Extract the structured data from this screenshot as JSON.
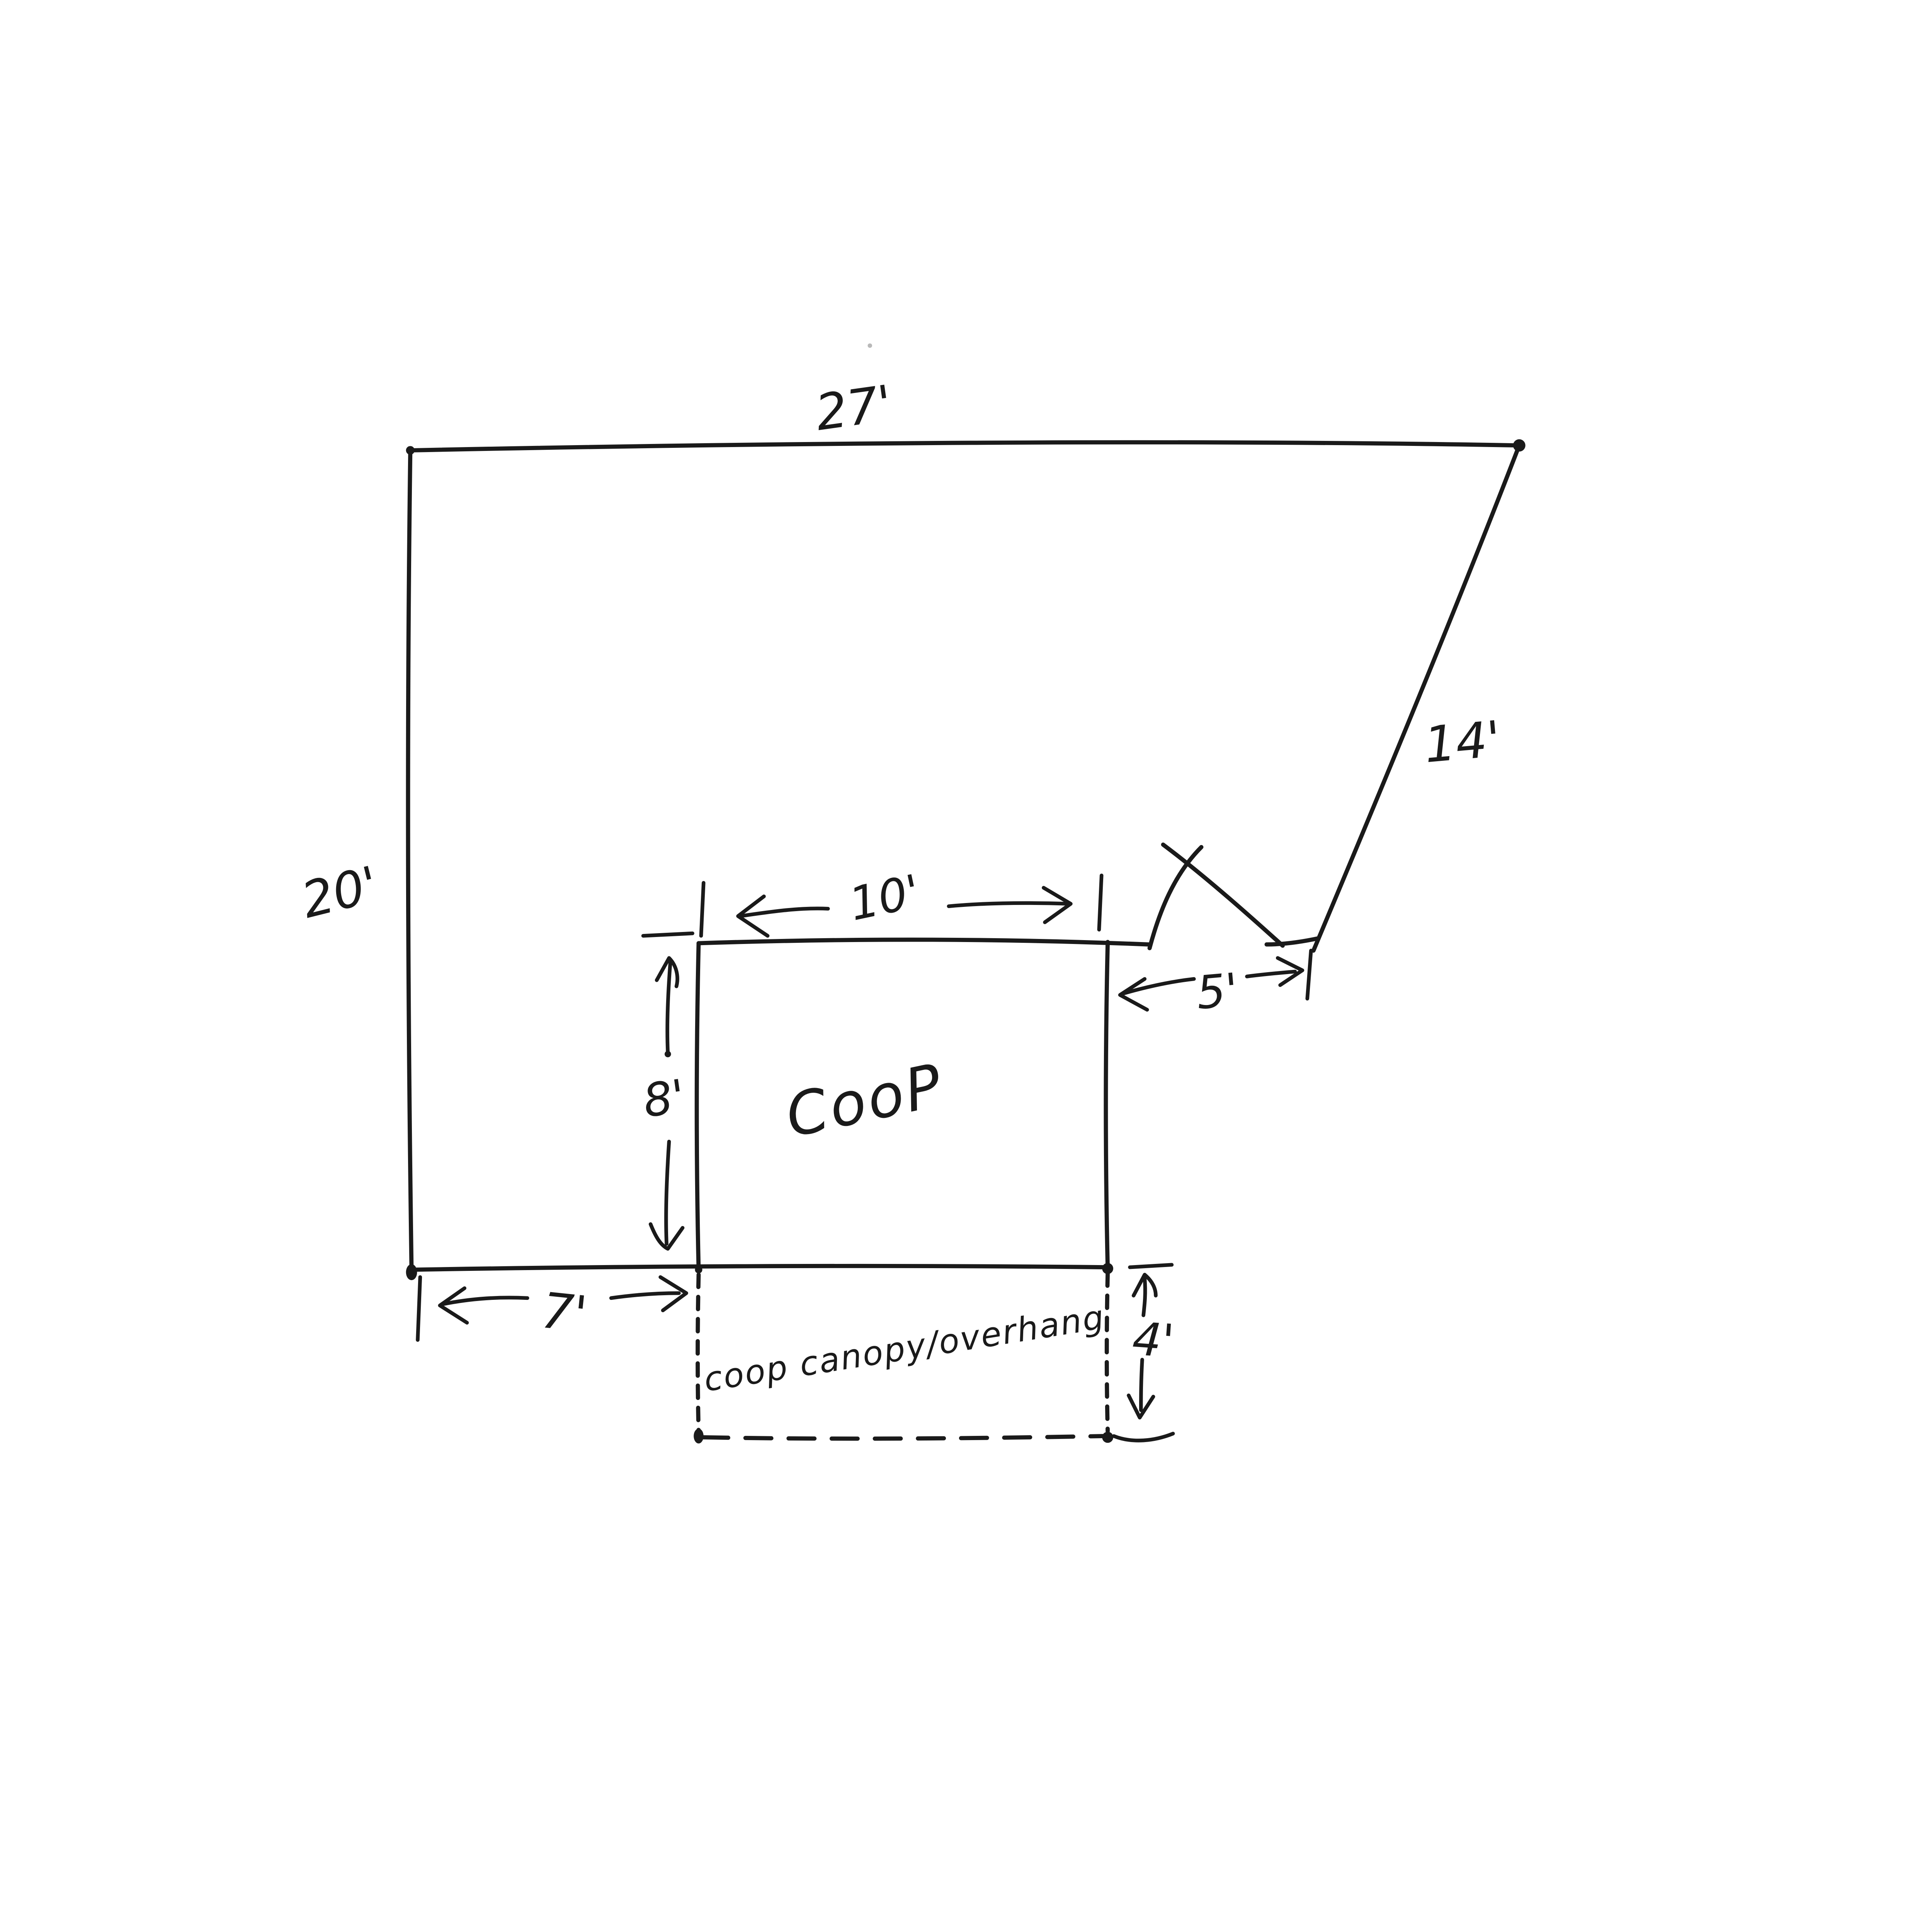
{
  "page": {
    "paper": "#ffffff",
    "ink": "#1a1a1a"
  },
  "sketch": {
    "dims": {
      "yard_top_width": "27'",
      "yard_left_height": "20'",
      "yard_right_diagonal": "14'",
      "coop_width": "10'",
      "coop_height": "8'",
      "gap_coop_to_fence": "5'",
      "offset_corner_to_coop": "7'",
      "canopy_depth": "4'"
    },
    "labels": {
      "coop": "CooP",
      "canopy": "coop canopy/overhang"
    }
  }
}
